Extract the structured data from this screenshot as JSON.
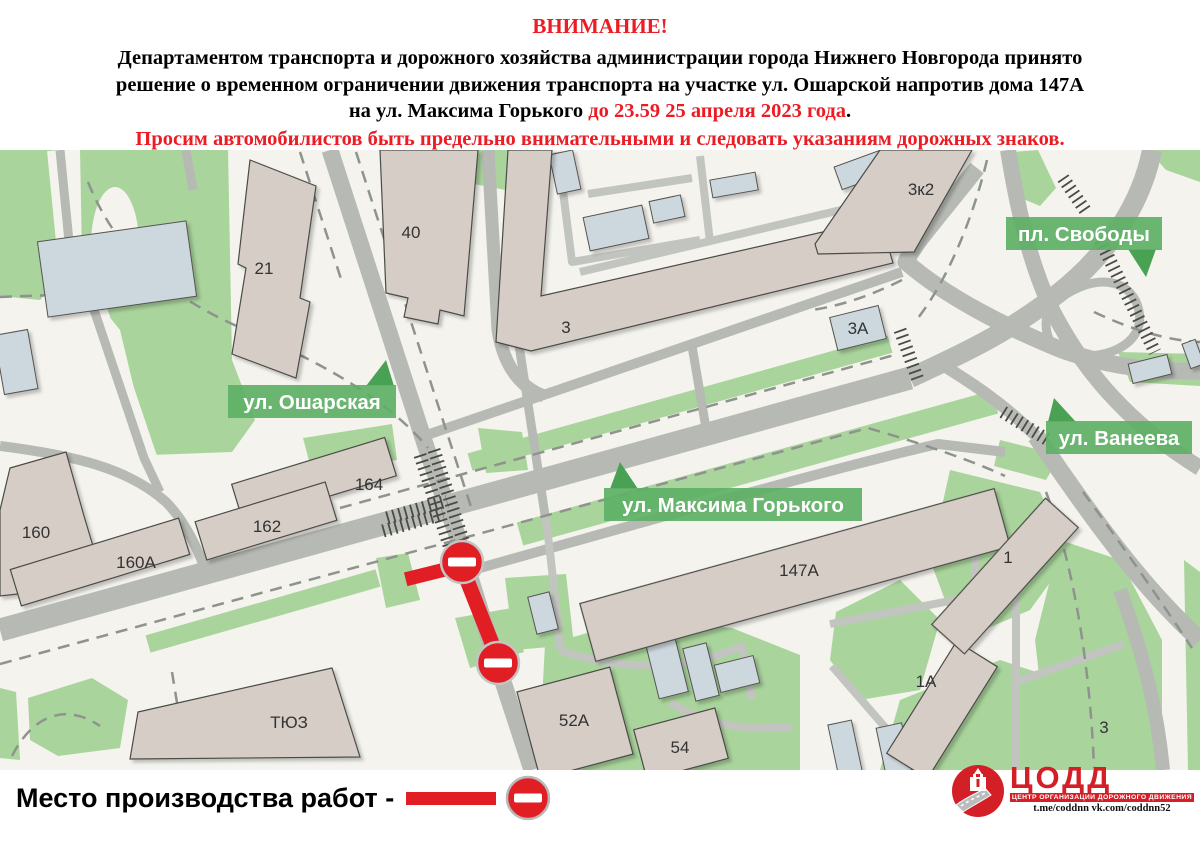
{
  "header": {
    "title": "ВНИМАНИЕ!",
    "line1": "Департаментом транспорта и дорожного хозяйства администрации города Нижнего Новгорода принято",
    "line2": "решение о временном ограничении движения транспорта на участке ул. Ошарской напротив дома 147А",
    "line3_black": "на ул.  Максима Горького ",
    "line3_red": "до 23.59 25 апреля 2023 года",
    "line3_tail": ".",
    "line4": "Просим автомобилистов быть предельно внимательными и следовать указаниям дорожных знаков."
  },
  "map": {
    "street_labels": {
      "osharskaya": "ул. Ошарская",
      "gorkogo": "ул. Максима Горького",
      "svobody": "пл. Свободы",
      "vaneeva": "ул. Ванеева"
    },
    "building_labels": [
      "21",
      "40",
      "3",
      "3к2",
      "3А",
      "164",
      "162",
      "160",
      "160А",
      "ТЮЗ",
      "147А",
      "52А",
      "54",
      "1А",
      "1",
      "3"
    ]
  },
  "legend": {
    "text": "Место производства работ -"
  },
  "logo": {
    "brand": "ЦОДД",
    "subtitle": "ЦЕНТР ОРГАНИЗАЦИИ ДОРОЖНОГО ДВИЖЕНИЯ",
    "links": "t.me/coddnn vk.com/coddnn52"
  },
  "colors": {
    "accent_red": "#e21e25",
    "header_red": "#ec1c24",
    "green_area": "#a9d49c",
    "ribbon_green": "#5fb066",
    "road_gray": "#b7bab4",
    "building_beige": "#d6cdc6",
    "building_blue": "#cdd8de"
  }
}
